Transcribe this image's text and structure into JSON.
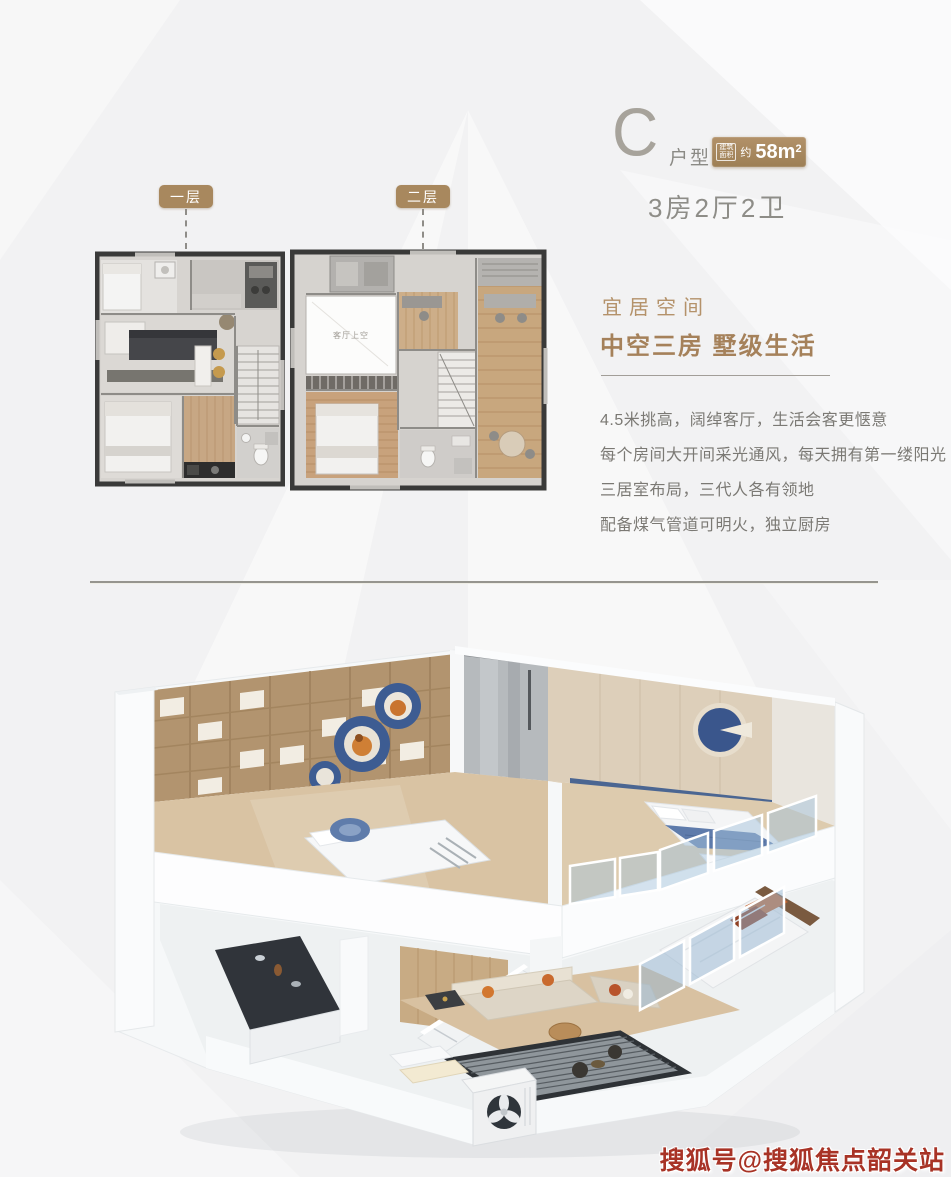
{
  "header": {
    "type_letter": "C",
    "type_label": "户型",
    "area_badge": {
      "box_line1": "建筑",
      "box_line2": "面积",
      "approx": "约",
      "value": "58m",
      "sup": "2"
    },
    "rooms_summary": "3房2厅2卫"
  },
  "floor_tabs": [
    {
      "label": "一层"
    },
    {
      "label": "二层"
    }
  ],
  "plans": {
    "void_label": "客厅上空"
  },
  "features": {
    "subtitle": "宜居空间",
    "title": "中空三房 墅级生活",
    "bullets": [
      "4.5米挑高，阔绰客厅，生活会客更惬意",
      "每个房间大开间采光通风，每天拥有第一缕阳光",
      "三居室布局，三代人各有领地",
      "配备煤气管道可明火，独立厨房"
    ]
  },
  "watermark": "搜狐号@搜狐焦点韶关站",
  "colors": {
    "accent": "#a8885e",
    "gold_text": "#a5815a",
    "body_text": "#7b7974",
    "watermark_red": "#a83326"
  }
}
